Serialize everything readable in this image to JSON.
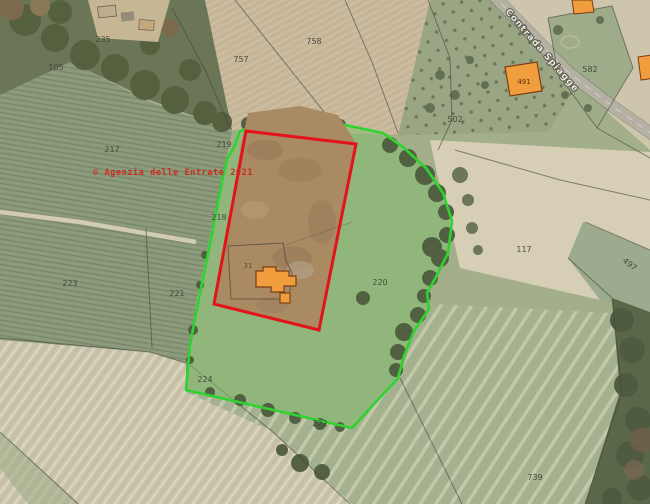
{
  "map": {
    "watermark_text": "© Agenzia delle Entrate 2021",
    "road_label": "Contrada Spiagge",
    "overlay_colors": {
      "selected_parcel_outline": "#e3131b",
      "area_overlay_outline": "#2fd32f",
      "area_overlay_fill": "rgba(60,210,60,0.16)",
      "building_fill": "#f09d3e",
      "building_outline": "#7a3c10",
      "watermark_color": "#cf2a20"
    },
    "parcel_labels": [
      {
        "text": "235"
      },
      {
        "text": "105"
      },
      {
        "text": "757"
      },
      {
        "text": "758"
      },
      {
        "text": "217"
      },
      {
        "text": "219"
      },
      {
        "text": "502"
      },
      {
        "text": "582"
      },
      {
        "text": "218"
      },
      {
        "text": "117"
      },
      {
        "text": "497"
      },
      {
        "text": "223"
      },
      {
        "text": "221"
      },
      {
        "text": "31"
      },
      {
        "text": "220"
      },
      {
        "text": "224"
      },
      {
        "text": "222"
      },
      {
        "text": "739"
      },
      {
        "text": "491"
      }
    ]
  }
}
